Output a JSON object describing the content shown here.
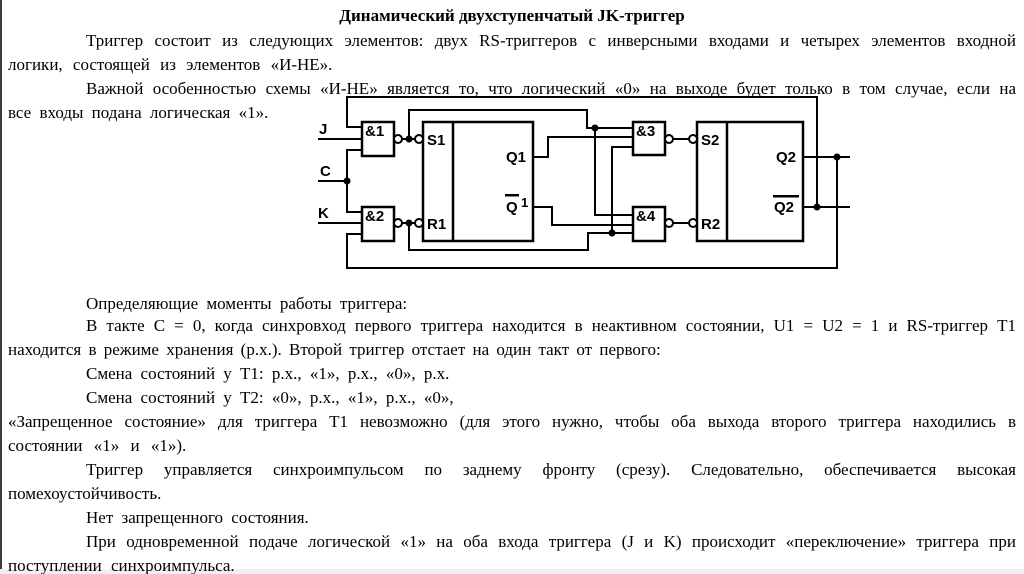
{
  "doc": {
    "title": "Динамический двухступенчатый JK-триггер",
    "paragraphs": [
      {
        "text": "Триггер состоит из следующих элементов: двух RS-триггеров с инверсными входами и четырех элементов входной логики, состоящей из элементов «И-НЕ»."
      },
      {
        "text": "Важной особенностью схемы «И-НЕ» является то, что логический «0» на выходе будет только в том случае, если на все входы подана логическая «1»."
      },
      {
        "text": "Определяющие моменты работы триггера:"
      },
      {
        "text": "В такте С = 0, когда синхровход первого триггера находится в неактивном состоянии, U1 = U2 = 1 и RS-триггер Т1 находится в режиме хранения (р.х.). Второй триггер отстает на один такт от первого:"
      },
      {
        "text": "Смена состояний у Т1: р.х., «1», р.х., «0», р.х."
      },
      {
        "text": "Смена состояний у Т2: «0», р.х., «1», р.х., «0»,"
      },
      {
        "text": "«Запрещенное состояние» для триггера Т1 невозможно (для этого нужно, чтобы оба выхода второго триггера находились в состоянии «1» и «1»)."
      },
      {
        "text": "Триггер управляется синхроимпульсом по заднему фронту (срезу). Следовательно, обеспечивается высокая помехоустойчивость."
      },
      {
        "text": "Нет запрещенного состояния."
      },
      {
        "text": "При одновременной подаче логической «1» на оба входа триггера (J и K) происходит «переключение» триггера при поступлении синхроимпульса."
      }
    ]
  },
  "schematic": {
    "inputs": {
      "j": "J",
      "c": "C",
      "k": "K"
    },
    "gates": {
      "g1": "&1",
      "g2": "&2",
      "g3": "&3",
      "g4": "&4"
    },
    "trigger1": {
      "s": "S1",
      "r": "R1",
      "q": "Q1",
      "nq_base": "Q",
      "nq_index": "1"
    },
    "trigger2": {
      "s": "S2",
      "r": "R2",
      "q": "Q2",
      "nq": "Q2"
    }
  },
  "colors": {
    "ink": "#000000",
    "paper": "#ffffff",
    "left_edge": "#3a3a3a",
    "bottom_strip": "#f0f0f0"
  }
}
